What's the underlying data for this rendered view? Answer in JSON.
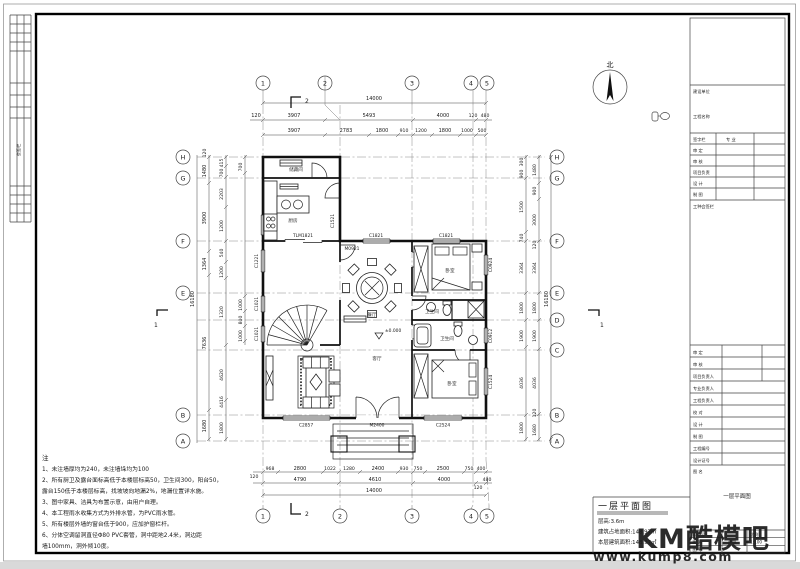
{
  "frame": {
    "strip_label": "会签栏"
  },
  "north": {
    "label": "北"
  },
  "axes": {
    "top": [
      "1",
      "2",
      "3",
      "4",
      "5"
    ],
    "bottom": [
      "1",
      "2",
      "3",
      "4",
      "5"
    ],
    "left": [
      "H",
      "G",
      "F",
      "E",
      "B",
      "A"
    ],
    "right": [
      "H",
      "G",
      "F",
      "E",
      "D",
      "C",
      "B",
      "A"
    ]
  },
  "section_markers": {
    "top": "2",
    "bottom": "2",
    "left": "1",
    "right": "1"
  },
  "dims": {
    "top_total": "14000",
    "top_row2": [
      "120",
      "3907",
      "5493",
      "4000",
      "120",
      "480"
    ],
    "top_row1": [
      "3907",
      "2783",
      "1800",
      "910",
      "1200",
      "1800",
      "1000",
      "500"
    ],
    "bottom_row1": [
      "120",
      "968",
      "2800",
      "1022",
      "1280",
      "2400",
      "930",
      "750",
      "2500",
      "750",
      "400"
    ],
    "bottom_row2": [
      "4790",
      "4610",
      "4000",
      "480",
      "120"
    ],
    "bottom_total": "14000",
    "left_outer": [
      "120",
      "1480",
      "3900",
      "1364",
      "7636",
      "1680"
    ],
    "left_mid": [
      "415",
      "700",
      "2203",
      "1200",
      "540",
      "1200",
      "1320",
      "4620",
      "4416",
      "1800"
    ],
    "left_inner": [
      "700",
      "1000",
      "800",
      "1000"
    ],
    "left_total": "16180",
    "right_inner": [
      "300",
      "900",
      "1500",
      "740",
      "3364",
      "1800",
      "1900",
      "4036",
      "1800"
    ],
    "right_outer": [
      "1480",
      "900",
      "3000",
      "120",
      "3364",
      "1800",
      "1900",
      "4036",
      "120",
      "1680"
    ],
    "right_total": "16180"
  },
  "tags": {
    "tlm1821": "TLM1821",
    "m0921": "M0921",
    "c1821a": "C1821",
    "c1821b": "C1821",
    "c1521": "C1521",
    "c1221": "C1221",
    "c1021a": "C1021",
    "c1021b": "C1021",
    "c2857": "C2857",
    "m2400": "M2400",
    "c2524": "C2524",
    "c0924": "C0924",
    "c0912": "C0912",
    "c1524": "C1524"
  },
  "rooms": {
    "storage": "储藏间",
    "kitchen": "厨房",
    "dining": "餐厅",
    "living": "客厅",
    "bedroom1": "卧室",
    "bedroom2": "卧室",
    "bath1": "卫生间",
    "bath2": "卫生间"
  },
  "level_mark": "±0.000",
  "notes": {
    "title": "注",
    "lines": [
      "1、未注墙厚均为240，未注墙垛均为100",
      "2、所有厨卫及露台面标高低于本楼层标高50，卫生间300，阳台50，",
      "露台150低于本楼层标高，找坡坡向地漏2%，地漏位置详水施。",
      "3、图中家具、洁具为布置示意，由用户自理。",
      "4、本工程雨水收集方式为外排水管，为PVC雨水管。",
      "5、所有楼层外墙的窗台低于900，应加护窗栏杆。",
      "6、分体空调留洞直径Φ80  PVC套管，洞中距地2.4米，洞边距",
      "墙100mm，洞外倾10度。"
    ]
  },
  "drawing_title": {
    "name": "一层平面图",
    "info": [
      "层高:3.6m",
      "建筑占地面积:148.97㎡",
      "本层建筑面积:148.97㎡"
    ]
  },
  "titleblock": {
    "owner_label": "建设单位",
    "project_label": "工程名称",
    "sign_header_l": "签字栏",
    "sign_header_r": "专 业",
    "sign_rows": [
      "审 定",
      "审 核",
      "项目负责",
      "设 计",
      "制 图"
    ],
    "seal_label": "工种会签栏",
    "rows": [
      "审 定",
      "审 核",
      "项目负责人",
      "专业负责人",
      "工程负责人",
      "校 对",
      "设 计",
      "制 图",
      "工程编号",
      "设计证号"
    ],
    "name_label": "图 名",
    "name_value": "一层平面图",
    "design_no_label": "设计号",
    "type_label": "图 别",
    "type_value": "建施",
    "no_label": "图 号",
    "scale_label": "比例",
    "scale_value": "1:100"
  },
  "watermark": {
    "brand": "KM酷模吧",
    "url": "www.kump8.com",
    "color": "#2aa7e3"
  }
}
